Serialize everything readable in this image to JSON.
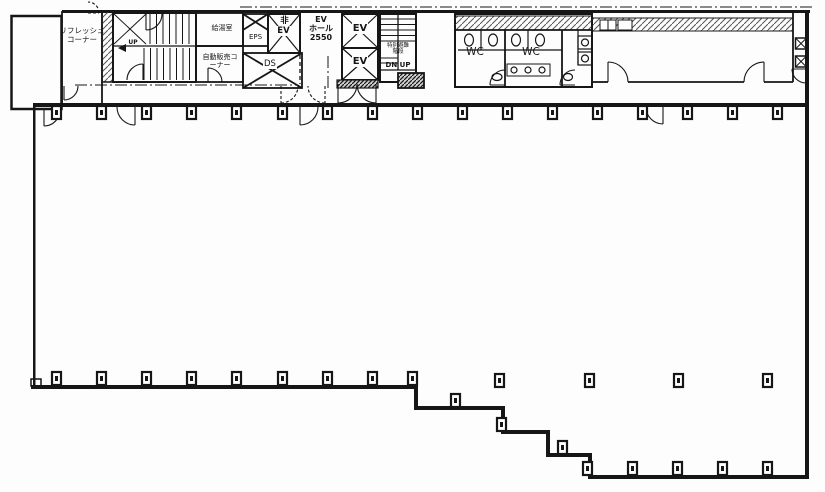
{
  "drawing": {
    "type": "architectural-floor-plan",
    "colors": {
      "ink": "#161616",
      "paper": "#fdfdfd"
    }
  },
  "labels": {
    "refresh_corner": "リフレッシュ\nコーナー",
    "kitchenette": "給湯室",
    "vending_corner": "自動販売コ\nーナー",
    "eps": "EPS",
    "emergency_ev": "非\nEV",
    "ev_hall": "EV\nホール\n2550",
    "ev_1": "EV",
    "ev_2": "EV",
    "duct_space": "DS",
    "stair_up": "UP",
    "evac_stair": "特別避難\n階段",
    "stair_dn_up": "DN UP",
    "wc_left": "WC",
    "wc_right": "WC"
  }
}
